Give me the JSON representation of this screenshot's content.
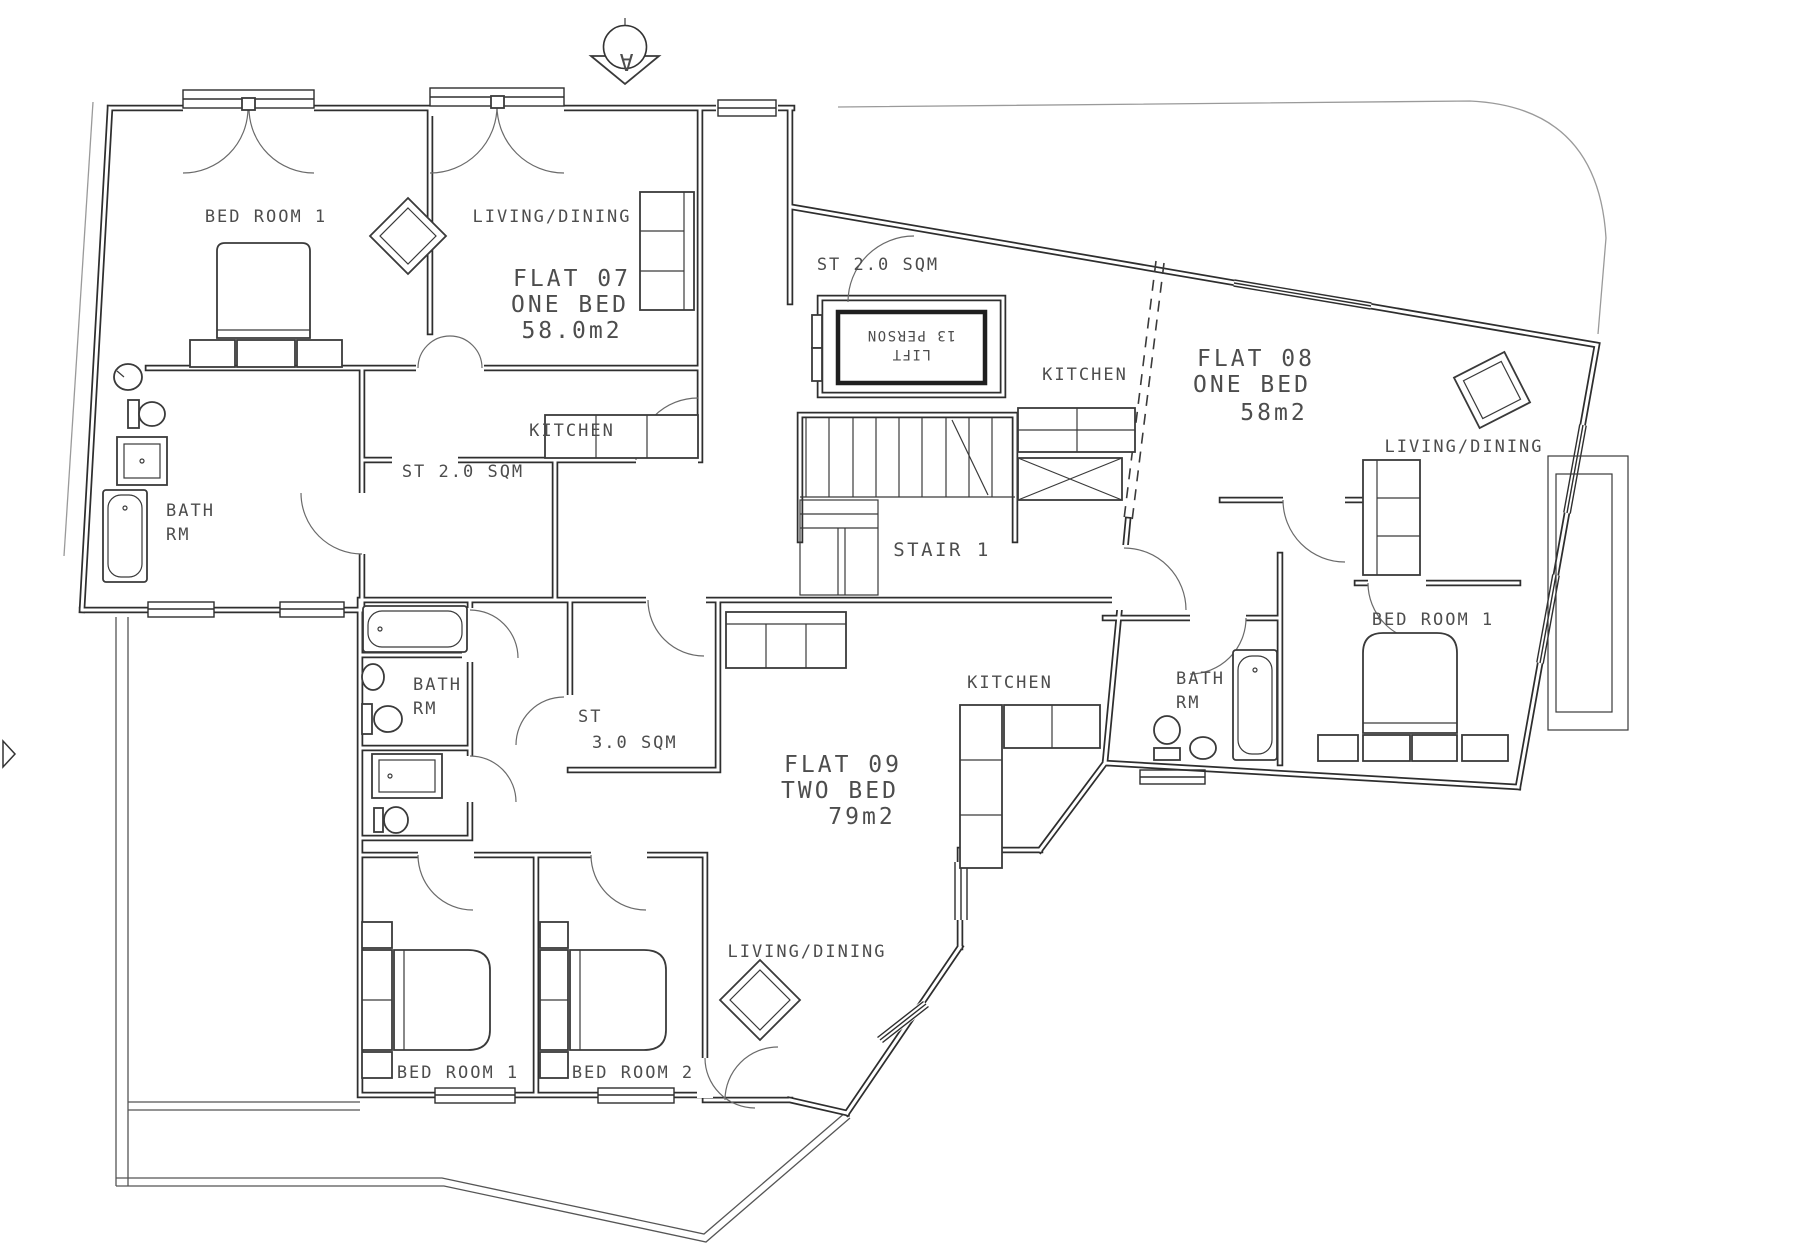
{
  "drawing_type": "floor-plan",
  "colors": {
    "wall": "#2e2e2e",
    "furniture": "#3a3a3a",
    "text": "#4d4d4d",
    "site_line": "#9a9a9a",
    "background": "#ffffff"
  },
  "markers": {
    "section": "A"
  },
  "core": {
    "storage": "ST 2.0 SQM",
    "lift_line1": "LIFT",
    "lift_line2": "13 PERSON",
    "stair": "STAIR 1"
  },
  "flat07": {
    "name": "FLAT 07",
    "type": "ONE BED",
    "area": "58.0m2",
    "bedroom": "BED ROOM 1",
    "living": "LIVING/DINING",
    "kitchen": "KITCHEN",
    "storage": "ST 2.0 SQM",
    "bath1": "BATH",
    "bath2": "RM"
  },
  "flat08": {
    "name": "FLAT 08",
    "type": "ONE BED",
    "area": "58m2",
    "kitchen": "KITCHEN",
    "living": "LIVING/DINING",
    "bedroom": "BED ROOM 1",
    "bath1": "BATH",
    "bath2": "RM"
  },
  "flat09": {
    "name": "FLAT 09",
    "type": "TWO BED",
    "area": "79m2",
    "kitchen": "KITCHEN",
    "living": "LIVING/DINING",
    "bedroom1": "BED ROOM 1",
    "bedroom2": "BED ROOM 2",
    "bath1": "BATH",
    "bath2": "RM",
    "st1": "ST",
    "st2": "3.0 SQM"
  }
}
